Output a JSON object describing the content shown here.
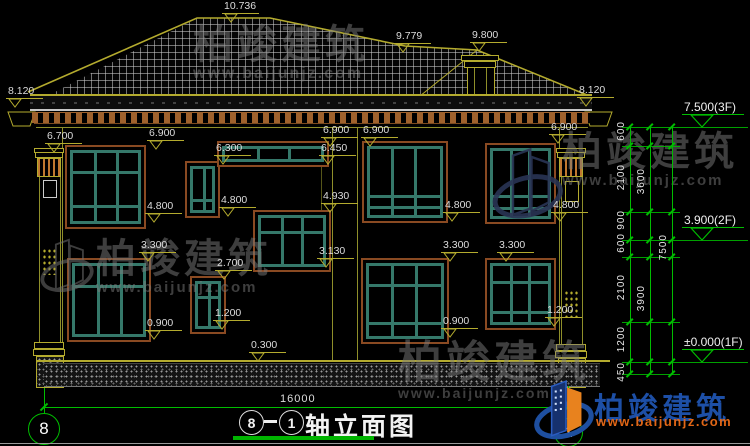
{
  "drawing": {
    "title": "轴立面图",
    "axis_left": "8",
    "axis_right": "1",
    "title_dash": "—",
    "overall_dim": "16000"
  },
  "levels": {
    "floor_markers": [
      {
        "text": "7.500(3F)",
        "y": 127
      },
      {
        "text": "3.900(2F)",
        "y": 240
      },
      {
        "text": "±0.000(1F)",
        "y": 362
      }
    ],
    "level_markers": [
      {
        "text": "10.736",
        "x": 222,
        "y": 22
      },
      {
        "text": "9.779",
        "x": 394,
        "y": 52
      },
      {
        "text": "9.800",
        "x": 470,
        "y": 51
      },
      {
        "text": "8.120",
        "x": 6,
        "y": 107
      },
      {
        "text": "8.120",
        "x": 577,
        "y": 106
      },
      {
        "text": "6.700",
        "x": 45,
        "y": 152
      },
      {
        "text": "6.900",
        "x": 147,
        "y": 149
      },
      {
        "text": "6.900",
        "x": 321,
        "y": 146
      },
      {
        "text": "6.900",
        "x": 361,
        "y": 146
      },
      {
        "text": "6.900",
        "x": 549,
        "y": 143
      },
      {
        "text": "6.450",
        "x": 319,
        "y": 164
      },
      {
        "text": "6.300",
        "x": 214,
        "y": 164
      },
      {
        "text": "4.930",
        "x": 321,
        "y": 212
      },
      {
        "text": "4.800",
        "x": 145,
        "y": 222
      },
      {
        "text": "4.800",
        "x": 219,
        "y": 216
      },
      {
        "text": "4.800",
        "x": 443,
        "y": 221
      },
      {
        "text": "4.800",
        "x": 551,
        "y": 221
      },
      {
        "text": "3.300",
        "x": 139,
        "y": 261
      },
      {
        "text": "3.300",
        "x": 441,
        "y": 261
      },
      {
        "text": "3.300",
        "x": 497,
        "y": 261
      },
      {
        "text": "3.130",
        "x": 317,
        "y": 267
      },
      {
        "text": "2.700",
        "x": 215,
        "y": 279
      },
      {
        "text": "1.200",
        "x": 213,
        "y": 329
      },
      {
        "text": "1.200",
        "x": 545,
        "y": 326
      },
      {
        "text": "0.900",
        "x": 145,
        "y": 339
      },
      {
        "text": "0.900",
        "x": 441,
        "y": 337
      },
      {
        "text": "0.300",
        "x": 249,
        "y": 361
      }
    ]
  },
  "dim_chain": {
    "lines_x": [
      630,
      650,
      672
    ],
    "ticks_y": [
      127,
      146,
      212,
      240,
      257,
      322,
      362,
      374
    ],
    "labels": [
      {
        "text": "600",
        "x": 630,
        "y": 137
      },
      {
        "text": "2100",
        "x": 630,
        "y": 180
      },
      {
        "text": "900",
        "x": 630,
        "y": 226
      },
      {
        "text": "600",
        "x": 630,
        "y": 249
      },
      {
        "text": "2100",
        "x": 630,
        "y": 290
      },
      {
        "text": "1200",
        "x": 630,
        "y": 342
      },
      {
        "text": "450",
        "x": 630,
        "y": 378
      },
      {
        "text": "3600",
        "x": 650,
        "y": 184
      },
      {
        "text": "3900",
        "x": 650,
        "y": 301
      },
      {
        "text": "7500",
        "x": 672,
        "y": 250
      }
    ]
  },
  "watermarks": [
    {
      "text": "柏竣建筑",
      "url": "www.baijunjz.com",
      "x": 193,
      "y": 24,
      "size": 40,
      "usize": 16
    },
    {
      "text": "柏竣建筑",
      "url": "www.baijunjz.com",
      "x": 96,
      "y": 238,
      "size": 40,
      "usize": 15
    },
    {
      "text": "柏竣建筑",
      "url": "www.baijunjz.com",
      "x": 562,
      "y": 131,
      "size": 40,
      "usize": 15
    },
    {
      "text": "柏竣建筑",
      "url": "www.baijunjz.com",
      "x": 398,
      "y": 340,
      "size": 44,
      "usize": 14
    }
  ],
  "logo": {
    "name": "柏竣建筑",
    "url": "www.baijunjz.com"
  }
}
